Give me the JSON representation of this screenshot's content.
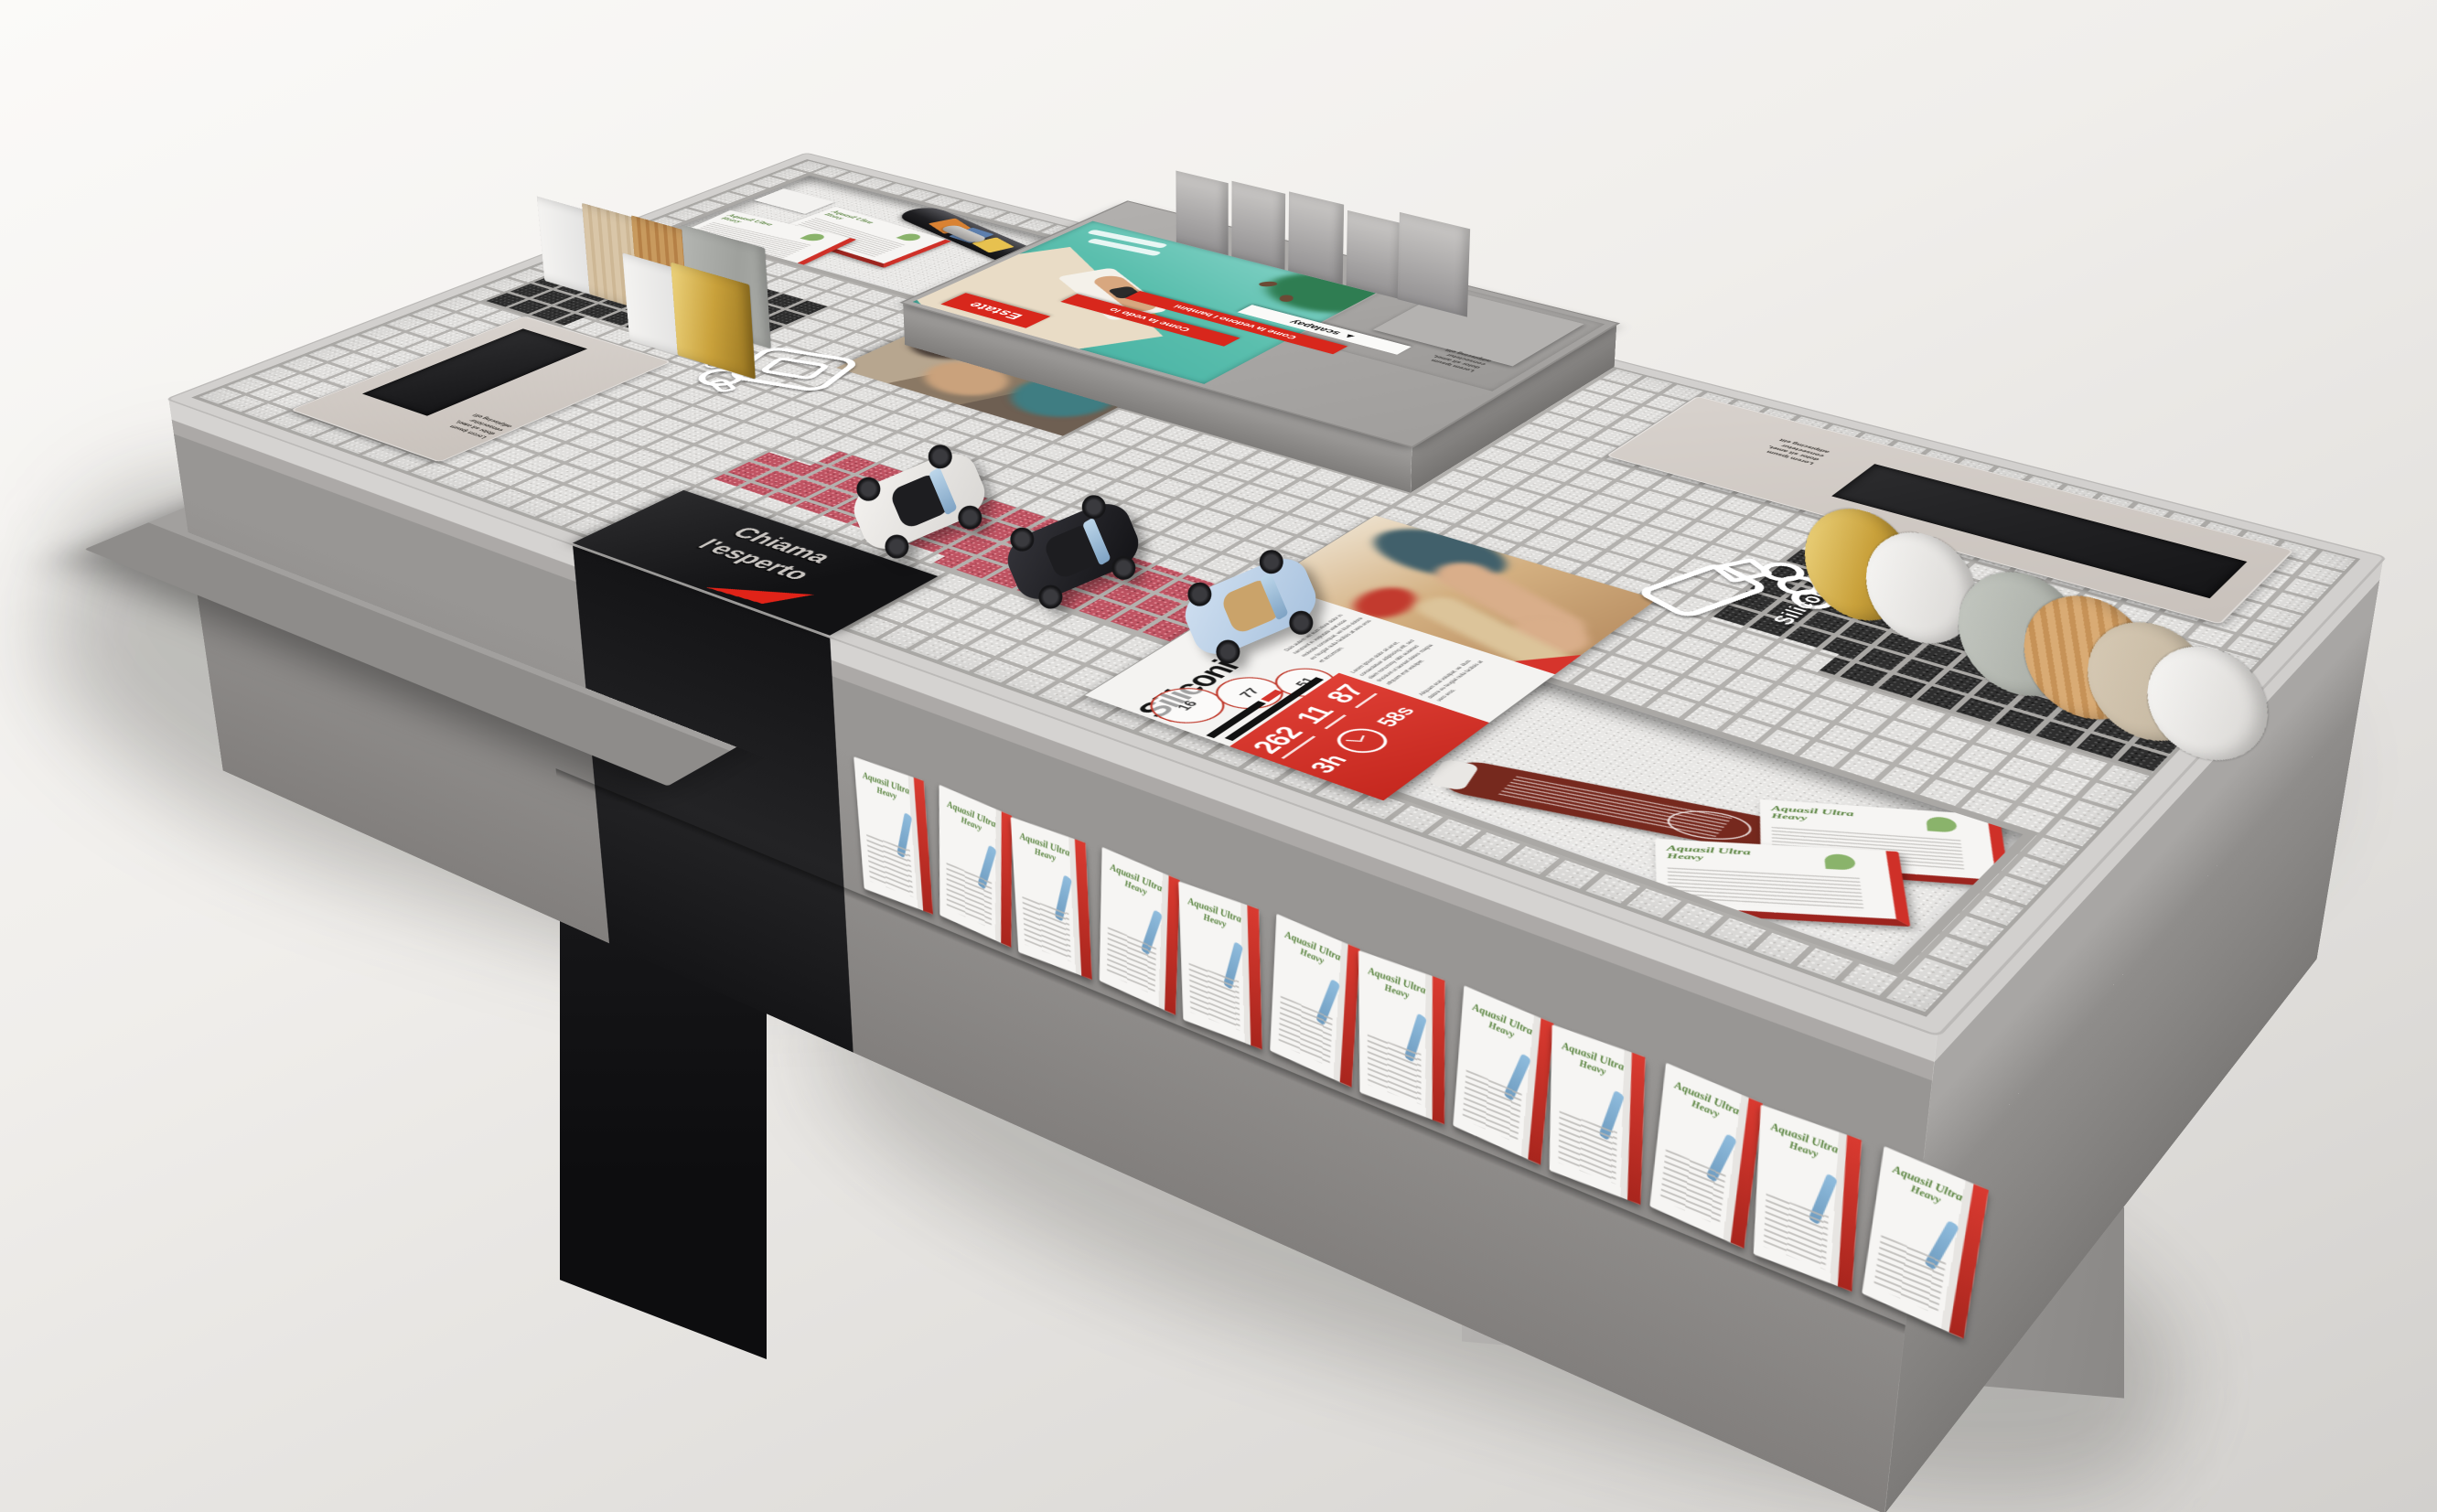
{
  "scene": {
    "description": "3D render of a hardware retail display table with grid top",
    "background_top": "#fbfaf8",
    "background_bottom": "#d2d0cd"
  },
  "colors": {
    "accent_red": "#d6342c",
    "panel_white": "#f4f3f1",
    "grid_bar": "#b3b1ae",
    "grid_cell": "#e0dfdd",
    "dark_cell": "#2e2e2e",
    "red_cell": "#bf5362",
    "dark_panel": "#1a1a1c"
  },
  "chiama_panel": {
    "line1": "Chiama",
    "line2": "l'esperto"
  },
  "zones": {
    "colle": {
      "label": "Colle",
      "wire_label": "Colle",
      "circles": [
        "78",
        "23",
        "37"
      ],
      "big_numbers": [
        "324",
        "15",
        "156"
      ],
      "hours": "2h",
      "seconds": "50s"
    },
    "siliconi": {
      "label": "Siliconi",
      "wire_label": "Siliconi",
      "circles": [
        "16",
        "77",
        "51"
      ],
      "big_numbers": [
        "262",
        "11",
        "87"
      ],
      "hours": "3h",
      "seconds": "58s"
    },
    "estate": {
      "title": "Estate",
      "banner_near": "Come la vedo io",
      "banner_far": "Come la vedono i bambini",
      "payment_label": "scalapay",
      "payment_arrow": "▲",
      "lorem": "Lorem ipsum\ndolor sit amet,\nconsectetur\nadipiscing elit"
    }
  },
  "plaques": {
    "lorem_lines": "Lorem ipsum\ndolor sit amet,\nconsectetur\nadipiscing elit"
  },
  "panel_paragraphs": {
    "p1": "Ut wisi enim ad minim veniam, quis nostrud exerci tation ullamcorper suscipit lobortis nisl ut aliquip ex ea commodo consequat.",
    "p2": "Duis autem vel eum iriure dolor in hendrerit in vulputate velit esse molestie consequat, vel illum dolore eu feugiat nulla facilisis at vero eros et accumsan.",
    "p3": "Lorem ipsum dolor sit amet, consectetuer adipiscing elit, sed diam nonummy nibh euismod tincidunt ut laoreet dolore magna aliquam erat volutpat.",
    "p4": "Aliquam erat volutpat, vel illum dolore eu feugiat nulla facilisis at vero eros."
  },
  "product": {
    "brand": "Aquasil Ultra",
    "variant": "Heavy"
  },
  "cars": [
    {
      "name": "white convertible",
      "color": "#ebe9e6"
    },
    {
      "name": "black convertible",
      "color": "#1a1a1d"
    },
    {
      "name": "light blue convertible",
      "color": "#bdd2e9"
    }
  ],
  "material_samples": {
    "left": [
      "#f2f1ef",
      "#d9c6a8",
      "#c89a5e",
      "#aeb0ac",
      "#f2f1ef",
      "#c9a13b"
    ],
    "right": [
      "#c9a13b",
      "#f2f1ef",
      "#b9bdb6",
      "#d2a06a",
      "#cfc2ae",
      "#f2f1ef"
    ]
  }
}
